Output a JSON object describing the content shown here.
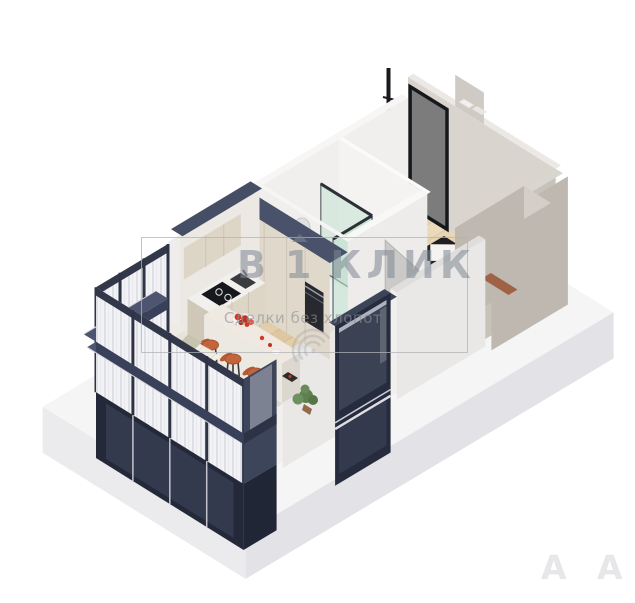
{
  "watermark": {
    "brand": "В 1 КЛИК",
    "brand_parts": [
      "В",
      "1",
      "КЛИК"
    ],
    "tagline": "Сделки без хлопот",
    "frame_color": "#b2b2b6",
    "text_color": "#7d8792"
  },
  "corner_marks": {
    "left": "A",
    "right": "A"
  },
  "palette": {
    "background": "#ffffff",
    "slab_top": "#f5f5f6",
    "slab_side": "#e7e7ea",
    "wood_floor": "#e9d4ad",
    "tile_black": "#1f1f22",
    "tile_white": "#f4f3f1",
    "wall_white": "#f0efed",
    "wall_taupe": "#c8c2bb",
    "navy_facade": "#262c3d",
    "navy_cap": "#4d5570",
    "cabinet_beige": "#ddd5c6",
    "counter_white": "#f2f0ec",
    "island_marble": "#efe9e1",
    "sofa_cream": "#f0ede6",
    "bed_teal": "#74929d",
    "stool_orange": "#c3653c",
    "glass_green": "#bfe0d2",
    "door_grey": "#cbcac8",
    "food_red": "#d43826",
    "plant_green": "#5f8150",
    "doormat_brown": "#a06244"
  }
}
